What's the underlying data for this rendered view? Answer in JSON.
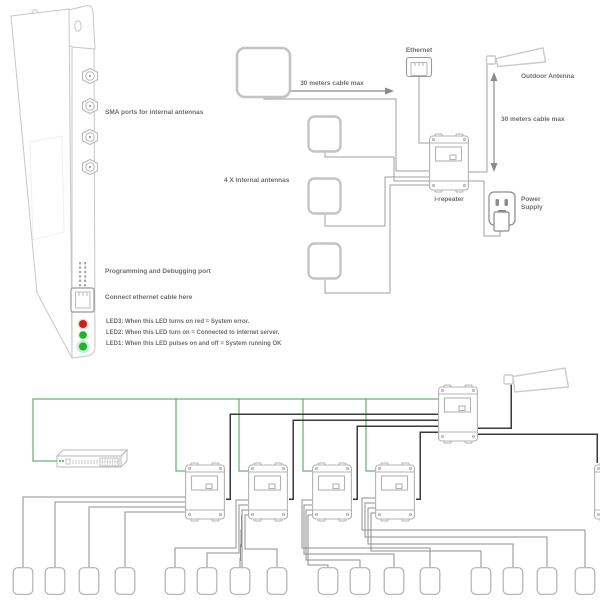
{
  "top": {
    "sma_ports_label": "SMA ports for internal antennas",
    "programming_port_label": "Programming and Debugging port",
    "ethernet_jack_label": "Connect ethernet cable here",
    "led3_label": "LED3: When  this LED turns on red = System error.",
    "led2_label": "LED2: When this LED turn on = Connected to internet server.",
    "led1_label": "LED1: When this LED pulses on and off = System running OK",
    "internal_antennas_label": "4 X  Internal antennas",
    "horizontal_cable_label": "30 meters cable max",
    "vertical_cable_label": "30 meters cable max",
    "ethernet_label": "Ethernet",
    "outdoor_antenna_label": "Outdoor Antenna",
    "repeater_label": "i-repeater",
    "power_supply_label": "Power Supply"
  },
  "colors": {
    "ethernet_green": "#3fa34d",
    "coax_black": "#3a3a3a",
    "antenna_cable_gray": "#8f8f8f",
    "outline_gray": "#c7c7c7",
    "led_red": "#cf1d12",
    "led_green": "#1db32a"
  }
}
